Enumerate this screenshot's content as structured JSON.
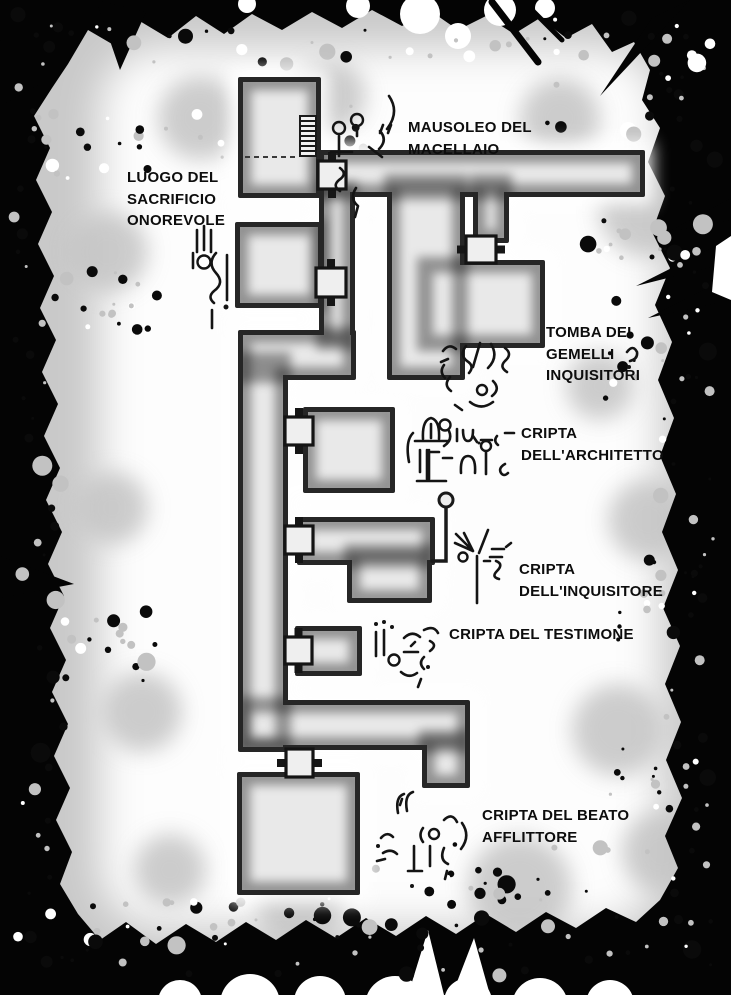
{
  "page": {
    "type": "dungeon-map",
    "language": "it"
  },
  "colors": {
    "ink": "#000000",
    "paper": "#ffffff",
    "floor": "#e9e9e9",
    "wall": "#2a2a2a",
    "mottle_gray": "#c6c6c6",
    "label_text": "#0d0d0d"
  },
  "rooms": [
    {
      "id": "mausoleo-del-macellaio",
      "label_lines": [
        "MAUSOLEO DEL",
        "MACELLAIO"
      ]
    },
    {
      "id": "luogo-del-sacrificio-onorevole",
      "label_lines": [
        "LUOGO DEL",
        "SACRIFICIO",
        "ONOREVOLE"
      ]
    },
    {
      "id": "tomba-dei-gemelli-inquisitori",
      "label_lines": [
        "TOMBA DEI",
        "GEMELLI",
        "INQUISITORI"
      ]
    },
    {
      "id": "cripta-dell-architetto",
      "label_lines": [
        "CRIPTA",
        "DELL'ARCHITETTO"
      ]
    },
    {
      "id": "cripta-dell-inquisitore",
      "label_lines": [
        "CRIPTA",
        "DELL'INQUISITORE"
      ]
    },
    {
      "id": "cripta-del-testimone",
      "label_lines": [
        "CRIPTA DEL TESTIMONE"
      ]
    },
    {
      "id": "cripta-del-beato-afflittore",
      "label_lines": [
        "CRIPTA DEL BEATO",
        "AFFLITTORE"
      ]
    }
  ],
  "icons": [
    {
      "name": "stairs-icon",
      "meaning": "staircase in Mausoleo del Macellaio"
    },
    {
      "name": "door-icon",
      "meaning": "door square between areas",
      "count": 7
    },
    {
      "name": "lever-icon",
      "meaning": "lever/torch beside Cripta dell'Inquisitore"
    },
    {
      "name": "dashed-line",
      "meaning": "secret passage marker in Mausoleo del Macellaio"
    },
    {
      "name": "glyph-doodles",
      "meaning": "hand-drawn arcane scribbles beside labels",
      "count": 7
    }
  ]
}
